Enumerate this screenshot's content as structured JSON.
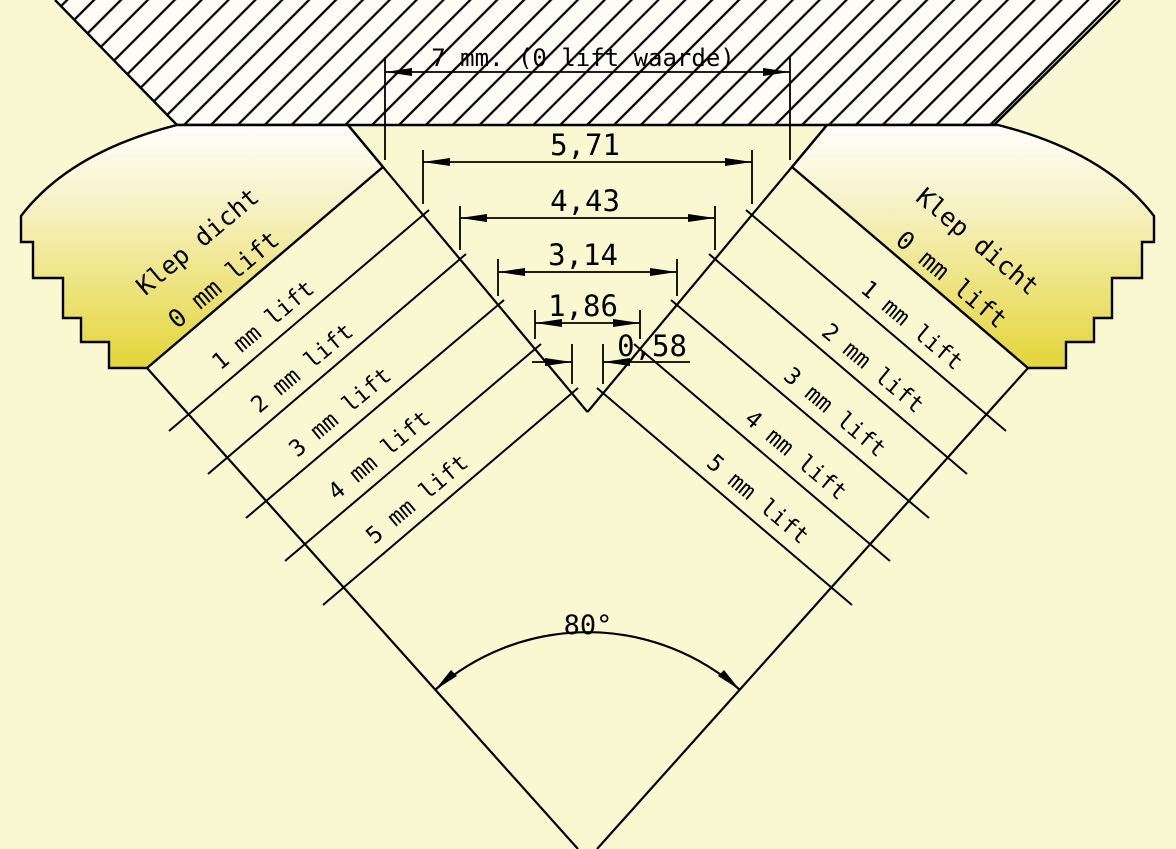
{
  "diagram": {
    "title_dimension": "7 mm. (0 lift waarde)",
    "seat_angle_label": "80°",
    "valve_closed": {
      "line1": "Klep dicht",
      "line2": "0 mm lift"
    },
    "lift_labels": [
      "1 mm lift",
      "2 mm lift",
      "3 mm lift",
      "4 mm lift",
      "5 mm lift"
    ],
    "gap_dimensions": [
      "5,71",
      "4,43",
      "3,14",
      "1,86",
      "0,58"
    ],
    "colors": {
      "background": "#faf8d0",
      "hatch_background": "#fdfdf6",
      "valve_yellow": "#e3d434",
      "line": "#000000"
    }
  }
}
